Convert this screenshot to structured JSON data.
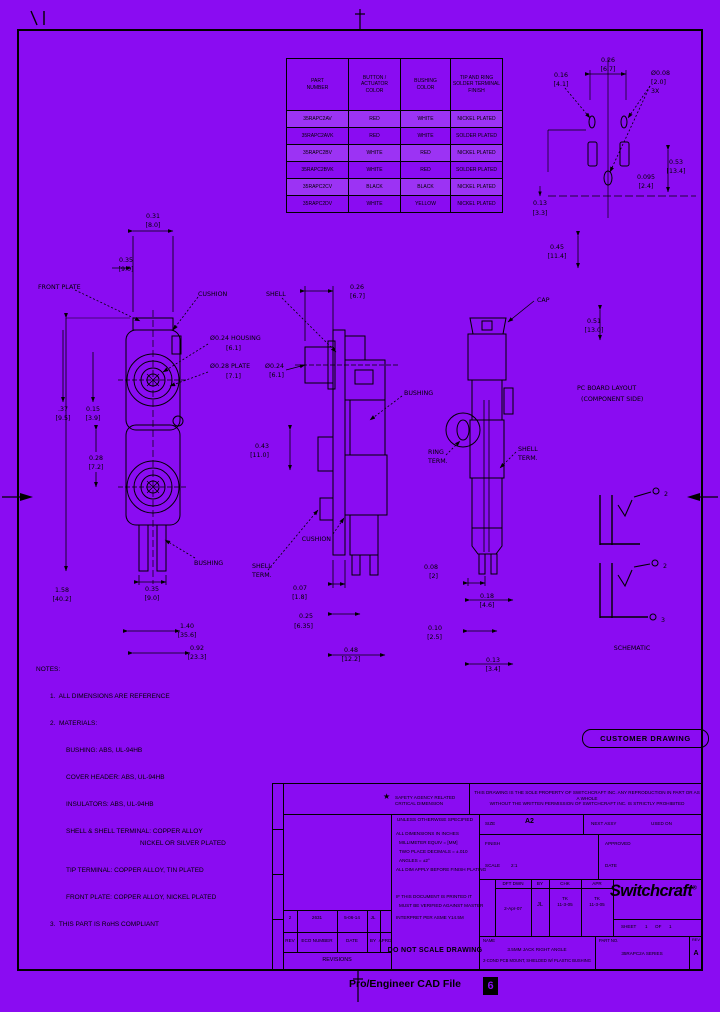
{
  "colors": {
    "background": "#8A0CF2",
    "line": "#000000",
    "row_stripe": "#A75BF5"
  },
  "stamp_label": "CUSTOMER DRAWING",
  "footer": {
    "text": "Pro/Engineer CAD File",
    "zone": "6"
  },
  "logo": {
    "name": "Switchcraft",
    "reg": "®"
  },
  "table": {
    "headers": [
      "PART\nNUMBER",
      "BUTTON /\nACTUATOR\nCOLOR",
      "BUSHING\nCOLOR",
      "TIP AND RING\nSOLDER TERMINAL\nFINISH"
    ],
    "rows": [
      [
        "35RAPC2AV",
        "RED",
        "WHITE",
        "NICKEL PLATED"
      ],
      [
        "35RAPC2AVK",
        "RED",
        "WHITE",
        "SOLDER PLATED"
      ],
      [
        "35RAPC2BV",
        "WHITE",
        "RED",
        "NICKEL PLATED"
      ],
      [
        "35RAPC2BVK",
        "WHITE",
        "RED",
        "SOLDER PLATED"
      ],
      [
        "35RAPC2CV",
        "BLACK",
        "BLACK",
        "NICKEL PLATED"
      ],
      [
        "35RAPC2DV",
        "WHITE",
        "YELLOW",
        "NICKEL PLATED"
      ]
    ]
  },
  "notes": {
    "lines": [
      "NOTES:",
      "1.  ALL DIMENSIONS ARE REFERENCE",
      "2.  MATERIALS:",
      "BUSHING: ABS, UL-94HB",
      "COVER HEADER: ABS, UL-94HB",
      "INSULATORS: ABS, UL-94HB",
      "SHELL & SHELL TERMINAL: COPPER ALLOY",
      "NICKEL OR SILVER PLATED",
      "TIP TERMINAL: COPPER ALLOY, TIN PLATED",
      "FRONT PLATE: COPPER ALLOY, NICKEL PLATED",
      "3.  THIS PART IS RoHS COMPLIANT"
    ]
  },
  "ann": {
    "f_top": "0.31",
    "f_top_mm": "[8.0]",
    "f_l1": "0.35",
    "f_l1_mm": "[9.0]",
    "front_plate": "FRONT PLATE",
    "cushion": "CUSHION",
    "housing_d": "Ø0.24 HOUSING",
    "housing_mm": "[6.1]",
    "plate_d": "Ø0.28 PLATE",
    "plate_mm": "[7.1]",
    "f_l2": ".37",
    "f_l2_mm": "[9.5]",
    "f_l3": "0.15",
    "f_l3_mm": "[3.9]",
    "f_l4": "0.28",
    "f_l4_mm": "[7.2]",
    "f_b1": "0.35",
    "f_b1_mm": "[9.0]",
    "f_b2": "1.58",
    "f_b2_mm": "[40.2]",
    "f_b3": "1.40",
    "f_b3_mm": "[35.6]",
    "f_b4": "0.92",
    "f_b4_mm": "[23.3]",
    "bushing_lbl": "BUSHING",
    "viewb1": "SHELL",
    "viewb2": "TERM.",
    "c_top": "0.26",
    "c_top_mm": "[6.7]",
    "shell_lbl": "SHELL",
    "c_d": "Ø0.24",
    "c_d_mm": "[6.1]",
    "c_l1": "0.43",
    "c_l1_mm": "[11.0]",
    "bushing2_lbl": "BUSHING",
    "cushion2": "CUSHION",
    "c_b1": "0.07",
    "c_b1_mm": "[1.8]",
    "c_b2": "0.25",
    "c_b2_mm": "[6.35]",
    "c_b3": "0.48",
    "c_b3_mm": "[12.2]",
    "cap_lbl": "CAP",
    "ring1": "RING",
    "ring2": "TERM.",
    "shterm1": "SHELL",
    "shterm2": "TERM.",
    "r_b1": "0.08",
    "r_b1_mm": "[2]",
    "r_b2": "0.10",
    "r_b2_mm": "[2.5]",
    "r_b3": "0.18",
    "r_b3_mm": "[4.6]",
    "r_b4": "0.13",
    "r_b4_mm": "[3.4]",
    "p_pitch": "0.26",
    "p_pitch_mm": "[6.7]",
    "p_l": "0.16",
    "p_l_mm": "[4.1]",
    "p_hole": "Ø0.08",
    "p_hole_mm": "[2.0]",
    "p_hole_qty": "3X",
    "p_r1": "0.53",
    "p_r1_mm": "[13.4]",
    "p_r2": "0.095",
    "p_r2_mm": "[2.4]",
    "p_b1": "0.13",
    "p_b1_mm": "[3.3]",
    "m_r1": "0.45",
    "m_r1_mm": "[11.4]",
    "m_r2": "0.51",
    "m_r2_mm": "[13.0]",
    "pcb1": "PC BOARD LAYOUT",
    "pcb2": "(COMPONENT SIDE)",
    "t2a": "2",
    "t2b": "2",
    "t3": "3",
    "sch": "SCHEMATIC"
  },
  "titleblock": {
    "star": "★",
    "star_note": "SAFETY AGENCY RELATED CRITICAL DIMENSION",
    "prop1": "THIS DRAWING IS THE SOLE PROPERTY OF SWITCHCRAFT INC.  ANY REPRODUCTION IN PART OR AS A WHOLE",
    "prop2": "WITHOUT THE WRITTEN PERMISSION OF SWITCHCRAFT INC. IS STRICTLY PROHIBITED",
    "uos": "UNLESS OTHERWISE SPECIFIED",
    "uos1": "ALL DIMENSIONS IN INCHES",
    "uos2": "MILLIMETER EQUIV = [MM]",
    "uos3": "TWO PLACE DECIMALS = ±.010",
    "uos4": "ANGLES = ±2°",
    "uos5": "ALL DIM APPLY BEFORE FINISH PLATING",
    "printed1": "IF THIS DOCUMENT IS PRINTED IT",
    "printed2": "MUST BE VERIFIED AGAINST MASTER",
    "printed3": "INTERPRET PER ASME Y14.5M",
    "do_not_scale": "DO NOT SCALE DRAWING",
    "size_label": "SIZE",
    "size_value": "A2",
    "next_assy": "NEXT ASSY",
    "used_on": "USED ON",
    "finish_label": "FINISH",
    "approved_label": "APPROVED",
    "scale_label": "SCALE",
    "scale_value": "2:1",
    "date_label": "DATE",
    "dft_label": "DFT DWN",
    "dft_value": "2-Apr-07",
    "by_label": "BY",
    "by_value": "JL",
    "chk_label": "CHK",
    "chk_value": "TK\n11-3-05",
    "apr_label": "APR",
    "apr_value": "TK\n11-3-05",
    "sheet_label": "SHEET",
    "sheet_value": "1",
    "of_label": "OF",
    "sheet_total": "1",
    "name_label": "NAME",
    "name1": "3.5MM JACK RIGHT ANGLE",
    "name2": "2-COND PCB MOUNT, SHIELDED W/ PLASTIC BUSHING",
    "part_label": "PART NO.",
    "part_value": "35RAPC2A SERIES",
    "rev_label": "REV",
    "rev_value": "A",
    "revisions": {
      "title": "REVISIONS",
      "h_rev": "REV",
      "h_eco": "ECO NUMBER",
      "h_date": "DATE",
      "h_by": "BY",
      "h_aprd": "APRD",
      "e_rev": "2",
      "e_eco": "2631",
      "e_date": "5-06-14",
      "e_by": "JL",
      "e_aprd": ""
    }
  }
}
